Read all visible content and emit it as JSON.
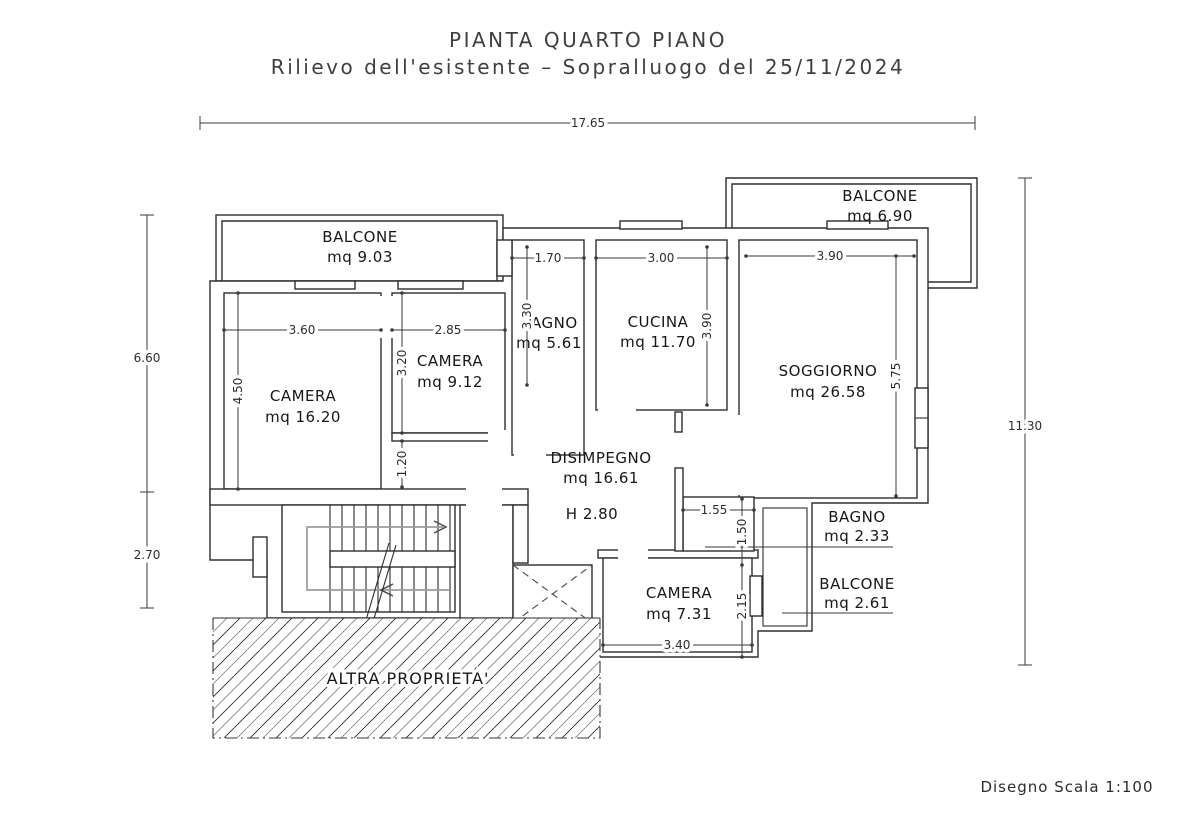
{
  "title": {
    "line1": "PIANTA QUARTO PIANO",
    "line2": "Rilievo dell'esistente – Sopralluogo del 25/11/2024"
  },
  "footer": {
    "scale_note": "Disegno Scala 1:100"
  },
  "rooms": {
    "balcone_nw": {
      "label": "BALCONE",
      "area": "mq 9.03"
    },
    "balcone_ne": {
      "label": "BALCONE",
      "area": "mq 6.90"
    },
    "camera_1": {
      "label": "CAMERA",
      "area": "mq 16.20"
    },
    "camera_2": {
      "label": "CAMERA",
      "area": "mq 9.12"
    },
    "bagno_1": {
      "label": "BAGNO",
      "area": "mq 5.61"
    },
    "cucina": {
      "label": "CUCINA",
      "area": "mq 11.70"
    },
    "soggiorno": {
      "label": "SOGGIORNO",
      "area": "mq 26.58"
    },
    "disimpegno": {
      "label": "DISIMPEGNO",
      "area": "mq 16.61",
      "height_note": "H 2.80"
    },
    "bagno_2": {
      "label": "BAGNO",
      "area": "mq 2.33"
    },
    "balcone_se": {
      "label": "BALCONE",
      "area": "mq 2.61"
    },
    "camera_3": {
      "label": "CAMERA",
      "area": "mq 7.31"
    },
    "altra_proprieta": {
      "label": "ALTRA PROPRIETA'"
    }
  },
  "dimensions": {
    "overall_width": "17.65",
    "left_upper": "6.60",
    "left_lower": "2.70",
    "overall_height": "11.30",
    "camera1_w": "3.60",
    "camera1_h": "4.50",
    "camera2_w": "2.85",
    "camera2_h": "3.20",
    "corridor": "1.20",
    "bagno1_w": "1.70",
    "bagno1_h": "3.30",
    "cucina_w": "3.00",
    "cucina_h": "3.90",
    "soggiorno_w": "3.90",
    "soggiorno_h": "5.75",
    "bagno2_w": "1.55",
    "bagno2_h": "1.50",
    "camera3_w": "3.40",
    "camera3_h": "2.15"
  },
  "colors": {
    "line": "#2e2e2e",
    "text": "#1f1f1f",
    "title": "#3f3f3f",
    "stair_route_gray": "#9c9c9c",
    "hatch_gray": "#8c8c8c",
    "background": "#ffffff"
  }
}
